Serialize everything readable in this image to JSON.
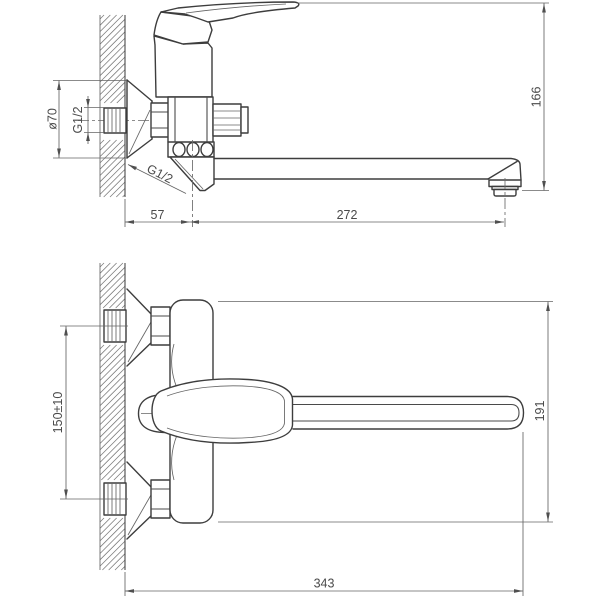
{
  "drawing": {
    "colors": {
      "background": "#ffffff",
      "object_line": "#3d3d3d",
      "dimension_line": "#646464",
      "text": "#4a4a4a"
    },
    "side_view": {
      "dims": {
        "flange_diameter": "ø70",
        "inlet_thread": "G1/2",
        "outlet_thread_leader": "G1/2",
        "wall_to_spout_axis": "57",
        "spout_axis_to_outlet": "272",
        "overall_height": "166"
      }
    },
    "plan_view": {
      "dims": {
        "inlet_spacing": "150±10",
        "body_depth": "191",
        "total_reach": "343"
      }
    }
  }
}
